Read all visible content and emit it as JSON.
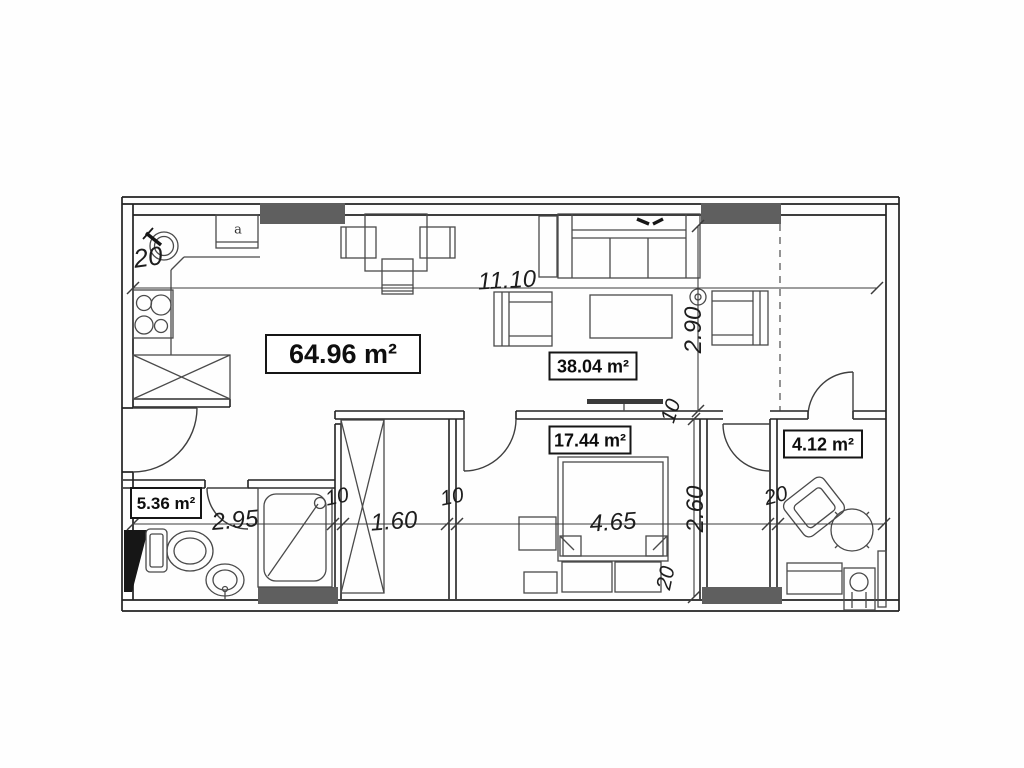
{
  "areas": {
    "total": "64.96 m²",
    "living": "38.04 m²",
    "bedroom": "17.44 m²",
    "room412": "4.12 m²",
    "bathroom": "5.36 m²"
  },
  "dims": {
    "top_width": "11.10",
    "living_depth": "2.90",
    "bath_width": "2.95",
    "hall_width": "1.60",
    "bed_width": "4.65",
    "bedroom_depth": "2.60",
    "wall20_topleft": "20",
    "wall20_mid": "20",
    "wall20_bottom": "20",
    "wall10_a": "10",
    "wall10_b": "10",
    "wall10_c": "10"
  },
  "kitchen": {
    "cabinet_letter": "a"
  },
  "colors": {
    "wall_line": "#222222",
    "furniture_line": "#4a4a4a",
    "pillar_fill": "#5f5f5f",
    "dim_line": "#3c3c3c",
    "label_border": "#161616",
    "background": "#fefefe"
  }
}
